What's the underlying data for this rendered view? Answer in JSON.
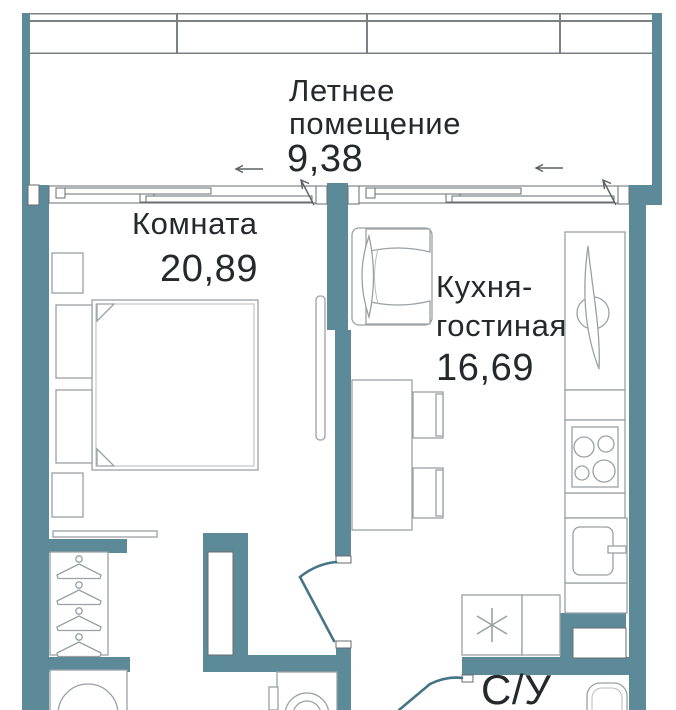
{
  "colors": {
    "wall": "#5d8a98",
    "furniture_line": "#9aa0a3",
    "window_frame_line": "#666c70",
    "door_swing": "#447586",
    "text": "#26292c"
  },
  "rooms": {
    "balcony": {
      "label_line1": "Летнее",
      "label_line2": "помещение",
      "area": "9,38"
    },
    "bedroom": {
      "label": "Комната",
      "area": "20,89"
    },
    "kitchen": {
      "label_line1": "Кухня-",
      "label_line2": "гостиная",
      "area": "16,69"
    },
    "bathroom": {
      "label": "С/У"
    }
  },
  "symbols": {
    "water_heater_mark": "✳"
  }
}
